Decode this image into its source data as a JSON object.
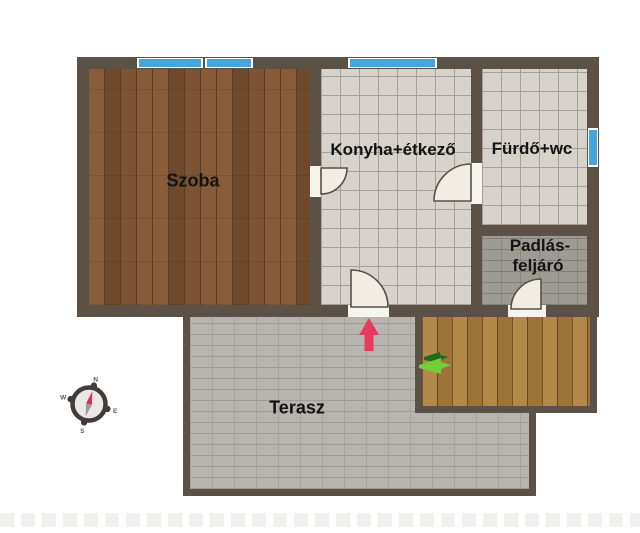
{
  "floorplan": {
    "rooms": {
      "szoba": {
        "label": "Szoba"
      },
      "konyha": {
        "label": "Konyha+étkező"
      },
      "furdo": {
        "label": "Fürdő+wc"
      },
      "padlas": {
        "label_line1": "Padlás-",
        "label_line2": "feljáró"
      },
      "terasz": {
        "label": "Terasz"
      }
    },
    "compass": {
      "north": "N",
      "east": "E",
      "south": "S",
      "west": "W"
    },
    "icons": {
      "entrance_arrow": "red-arrow-up",
      "direction_arrow": "green-arrow-right",
      "compass": "compass-rose"
    },
    "colors": {
      "wall": "#5b5147",
      "wood_floor": "#7a5233",
      "tile_light": "#d7d3cc",
      "tile_dark_brick": "#9e9a94",
      "terrace_brick": "#b8b5b0",
      "deck_wood": "#a87f41",
      "window_blue": "#45a4d9",
      "door_leaf": "#f2ede3",
      "entrance_arrow_red": "#e73a5e",
      "arrow_green_dark": "#1e6b1e",
      "arrow_green_light": "#72cf35",
      "label_text": "#141414",
      "background": "#ffffff"
    }
  }
}
